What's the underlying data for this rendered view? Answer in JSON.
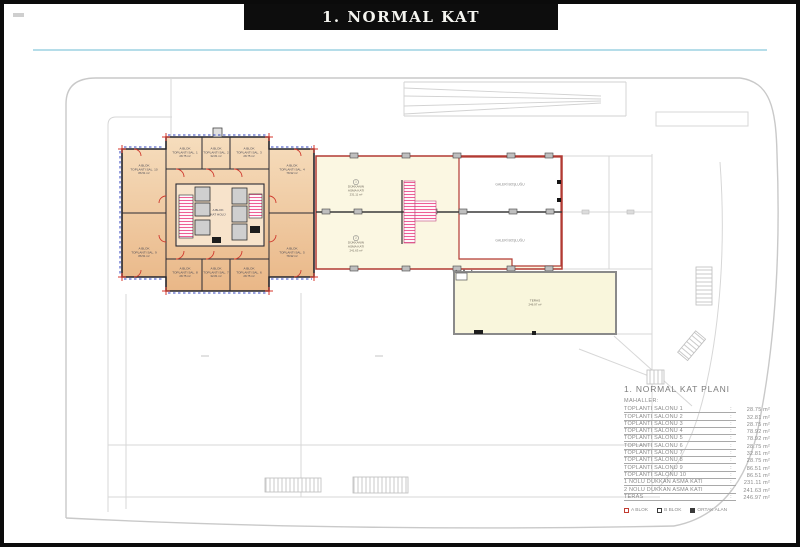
{
  "title": "1. NORMAL KAT",
  "colors": {
    "a_blok_fill": "#f0c79e",
    "a_blok_outline": "#c23b30",
    "wing_fill": "#fbf7e2",
    "wing_outline": "#b23a33",
    "stair_hatch": "#ee5f95",
    "window_dash": "#3346c2",
    "accent_line": "#b5dde9",
    "site_gray": "#c9c9c9"
  },
  "tower": {
    "hall_line1": "A BLOK",
    "hall_line2": "KAT HOLÜ",
    "rooms": [
      {
        "block": "A BLOK",
        "name": "TOPLANTI SAL. 1",
        "area": "28.75 m²"
      },
      {
        "block": "A BLOK",
        "name": "TOPLANTI SAL. 2",
        "area": "32.81 m²"
      },
      {
        "block": "A BLOK",
        "name": "TOPLANTI SAL. 3",
        "area": "28.75 m²"
      },
      {
        "block": "A BLOK",
        "name": "TOPLANTI SAL. 4",
        "area": "78.92 m²"
      },
      {
        "block": "A BLOK",
        "name": "TOPLANTI SAL. 5",
        "area": "78.92 m²"
      },
      {
        "block": "A BLOK",
        "name": "TOPLANTI SAL. 6",
        "area": "28.75 m²"
      },
      {
        "block": "A BLOK",
        "name": "TOPLANTI SAL. 7",
        "area": "32.81 m²"
      },
      {
        "block": "A BLOK",
        "name": "TOPLANTI SAL. 8",
        "area": "28.75 m²"
      },
      {
        "block": "A BLOK",
        "name": "TOPLANTI SAL. 9",
        "area": "86.51 m²"
      },
      {
        "block": "A BLOK",
        "name": "TOPLANTI SAL. 10",
        "area": "86.51 m²"
      }
    ]
  },
  "wing": {
    "mezzanines": [
      {
        "num": "1",
        "line1": "DÜKKANIN",
        "line2": "ASMA KATI",
        "area": "231.11 m²"
      },
      {
        "num": "2",
        "line1": "DÜKKANIN",
        "line2": "ASMA KATI",
        "area": "241.63 m²"
      }
    ],
    "gallery_label": "GALERİ BOŞLUĞU"
  },
  "teras": {
    "name": "TERAS",
    "area": "246.97 m²"
  },
  "legend": {
    "title": "1. NORMAL KAT PLANI",
    "subtitle": "MAHALLER:",
    "colon": ":",
    "rows": [
      {
        "label": "TOPLANTI SALONU 1",
        "area": "28.75 m²"
      },
      {
        "label": "TOPLANTI SALONU 2",
        "area": "32.81 m²"
      },
      {
        "label": "TOPLANTI SALONU 3",
        "area": "28.75 m²"
      },
      {
        "label": "TOPLANTI SALONU 4",
        "area": "78.92 m²"
      },
      {
        "label": "TOPLANTI SALONU 5",
        "area": "78.92 m²"
      },
      {
        "label": "TOPLANTI SALONU 6",
        "area": "28.75 m²"
      },
      {
        "label": "TOPLANTI SALONU 7",
        "area": "32.81 m²"
      },
      {
        "label": "TOPLANTI SALONU 8",
        "area": "28.75 m²"
      },
      {
        "label": "TOPLANTI SALONU 9",
        "area": "86.51 m²"
      },
      {
        "label": "TOPLANTI SALONU 10",
        "area": "86.51 m²"
      },
      {
        "label": "1 NOLU DÜKKAN ASMA KATI",
        "area": "231.11 m²"
      },
      {
        "label": "2 NOLU DÜKKAN ASMA KATI",
        "area": "241.63 m²"
      },
      {
        "label": "TERAS",
        "area": "246.97 m²"
      }
    ],
    "key": [
      {
        "label": "A BLOK",
        "color": "#c23b30",
        "filled": false
      },
      {
        "label": "B BLOK",
        "color": "#3a3a3a",
        "filled": false
      },
      {
        "label": "ORTAK ALAN",
        "color": "#3a3a3a",
        "filled": true
      }
    ]
  }
}
